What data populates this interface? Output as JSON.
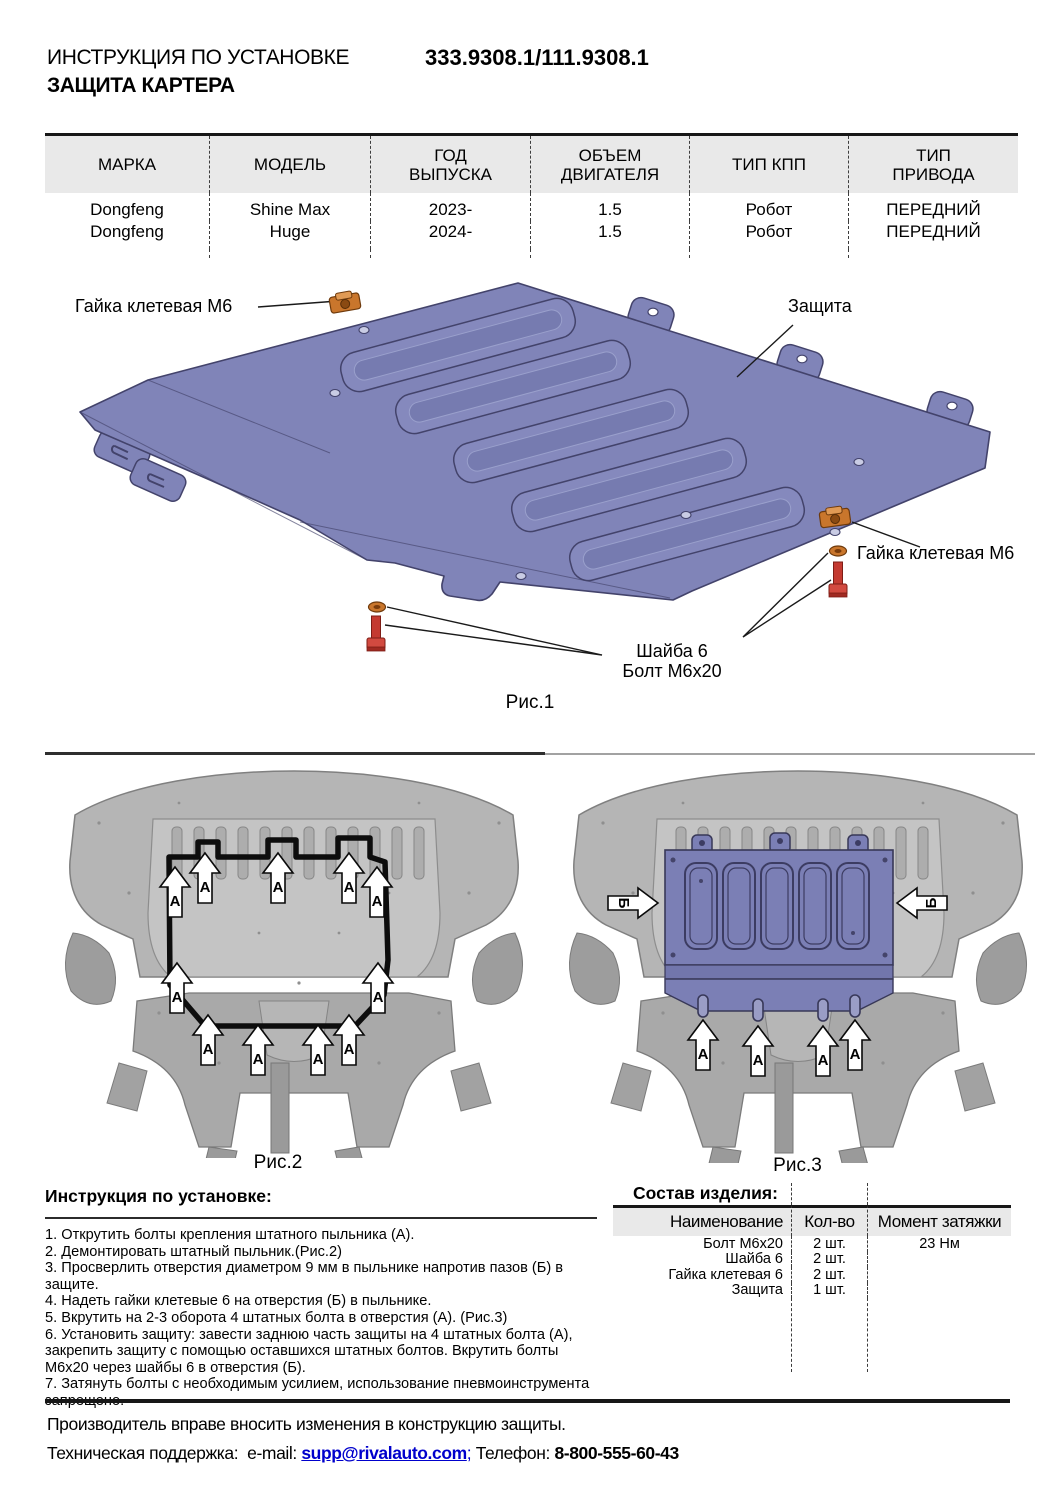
{
  "header": {
    "title_line1": "ИНСТРУКЦИЯ ПО УСТАНОВКЕ",
    "title_line2": "ЗАЩИТА КАРТЕРА",
    "part_number": "333.9308.1/111.9308.1"
  },
  "spec_table": {
    "columns": [
      {
        "l1": "МАРКА",
        "l2": ""
      },
      {
        "l1": "МОДЕЛЬ",
        "l2": ""
      },
      {
        "l1": "ГОД",
        "l2": "ВЫПУСКА"
      },
      {
        "l1": "ОБЪЕМ",
        "l2": "ДВИГАТЕЛЯ"
      },
      {
        "l1": "ТИП КПП",
        "l2": ""
      },
      {
        "l1": "ТИП",
        "l2": "ПРИВОДА"
      }
    ],
    "rows": [
      [
        "Dongfeng",
        "Shine Max",
        "2023-",
        "1.5",
        "Робот",
        "ПЕРЕДНИЙ"
      ],
      [
        "Dongfeng",
        "Huge",
        "2024-",
        "1.5",
        "Робот",
        "ПЕРЕДНИЙ"
      ]
    ]
  },
  "fig1": {
    "caption": "Рис.1",
    "labels": {
      "nut_top": "Гайка клетевая М6",
      "shield": "Защита",
      "nut_right": "Гайка клетевая М6",
      "washer": "Шайба 6",
      "bolt": "Болт М6х20"
    }
  },
  "fig2": {
    "caption": "Рис.2",
    "marker_label": "А",
    "markers": [
      {
        "x": 120,
        "y": 104
      },
      {
        "x": 150,
        "y": 90
      },
      {
        "x": 223,
        "y": 90
      },
      {
        "x": 294,
        "y": 90
      },
      {
        "x": 322,
        "y": 104
      },
      {
        "x": 122,
        "y": 200
      },
      {
        "x": 323,
        "y": 200
      },
      {
        "x": 153,
        "y": 252
      },
      {
        "x": 203,
        "y": 262
      },
      {
        "x": 263,
        "y": 262
      },
      {
        "x": 294,
        "y": 252
      }
    ]
  },
  "fig3": {
    "caption": "Рис.3",
    "marker_label_a": "А",
    "marker_label_b": "Б",
    "markers_a": [
      {
        "x": 148,
        "y": 257
      },
      {
        "x": 203,
        "y": 263
      },
      {
        "x": 268,
        "y": 263
      },
      {
        "x": 300,
        "y": 257
      }
    ],
    "markers_b": [
      {
        "x": 103,
        "y": 140,
        "rot": 90
      },
      {
        "x": 342,
        "y": 140,
        "rot": -90
      }
    ]
  },
  "instructions": {
    "heading": "Инструкция по установке:",
    "steps": [
      "1. Открутить болты крепления штатного пыльника (А).",
      "2. Демонтировать штатный пыльник.(Рис.2)",
      "3. Просверлить отверстия диаметром 9 мм в пыльнике напротив пазов (Б) в защите.",
      "4. Надеть гайки клетевые 6 на отверстия (Б) в пыльнике.",
      "5. Вкрутить на 2-3 оборота 4 штатных болта в отверстия (А). (Рис.3)",
      "6. Установить защиту: завести заднюю часть защиты на 4 штатных болта (А), закрепить защиту с помощью оставшихся штатных болтов. Вкрутить болты М6х20 через шайбы 6 в отверстия (Б).",
      "7. Затянуть болты с необходимым усилием, использование пневмоинструмента запрещено."
    ]
  },
  "parts_table": {
    "heading": "Состав изделия:",
    "columns": [
      "Наименование",
      "Кол-во",
      "Момент затяжки"
    ],
    "rows": [
      {
        "name": "Болт М6х20",
        "qty": "2 шт.",
        "torque": "23 Нм"
      },
      {
        "name": "Шайба 6",
        "qty": "2 шт.",
        "torque": ""
      },
      {
        "name": "Гайка клетевая 6",
        "qty": "2 шт.",
        "torque": ""
      },
      {
        "name": "Защита",
        "qty": "1 шт.",
        "torque": ""
      }
    ]
  },
  "footer": {
    "line1": "Производитель вправе вносить изменения в конструкцию защиты.",
    "support_label": "Техническая поддержка:  e-mail:",
    "email": "supp@rivalauto.com",
    "separator": ";",
    "phone_label": "Телефон:",
    "phone": "8-800-555-60-43"
  },
  "colors": {
    "shield_purple": "#8084b8",
    "shield_dark": "#43436b",
    "hardware_orange": "#c9762c",
    "bolt_red": "#c43a31",
    "link_blue": "#0000cc",
    "table_header_gray": "#e9e9e9"
  }
}
